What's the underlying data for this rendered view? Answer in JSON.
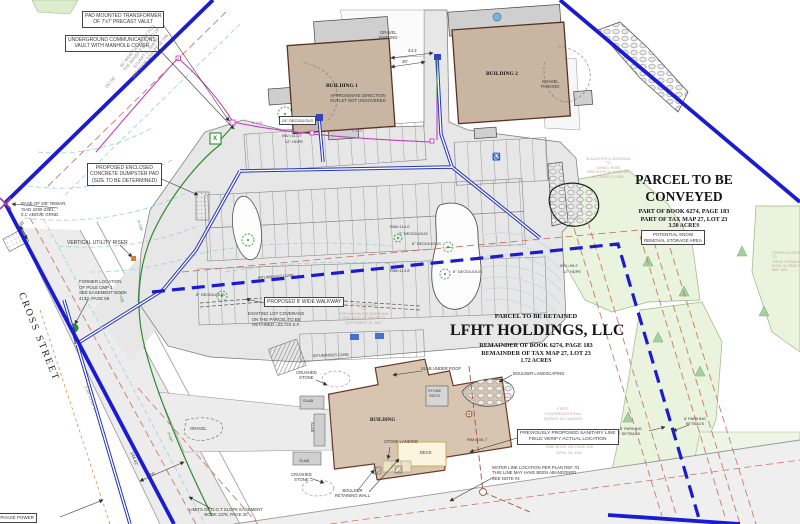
{
  "colors": {
    "boundary_blue": "#1b1bd0",
    "water_blue": "#2233bb",
    "electric_magenta": "#c43ec4",
    "power_green": "#2e8b2e",
    "contour_cyan": "#9fd0d6",
    "setback_red": "#c8796b",
    "building_fill": "#c8b6a3",
    "building_outline": "#5d3222",
    "pavement_gray": "#e7e7e7",
    "vegetation_green": "#e9f3dd"
  },
  "parcel_conveyed": {
    "t1": "PARCEL TO BE",
    "t2": "CONVEYED",
    "l1": "PART OF BOOK 6274, PAGE 183",
    "l2": "PART OF TAX MAP 27, LOT 23",
    "l3": "3.50 ACRES"
  },
  "parcel_retained": {
    "sub": "PARCEL TO BE RETAINED",
    "t": "LFHT HOLDINGS, LLC",
    "l1": "REMAINDER OF BOOK 6274, PAGE 183",
    "l2": "REMAINDER OF TAX MAP 27, LOT 23",
    "l3": "1.72 ACRES"
  },
  "callouts": {
    "pad": [
      "PAD MOUNTED TRANSFORMER",
      "OF 7'x7' PRECAST VAULT"
    ],
    "comm": [
      "UNDERGROUND COMMUNICATIONS",
      "VAULT WITH MANHOLE COVER"
    ],
    "dumpster": [
      "PROPOSED ENCLOSED",
      "CONCRETE DUMPSTER PAD",
      "(SIZE TO BE DETERMINED)"
    ],
    "walkway": "PROPOSED 8' WIDE WALKWAY",
    "snow": [
      "POTENTIAL SNOW",
      "REMOVAL STORAGE AREA"
    ],
    "sanitary": [
      "PREVIOUSLY PROPOSED SANITARY LINE",
      "FIELD VERIFY ACTUAL LOCATION"
    ],
    "phase_power": "E TO 3 PHASE POWER",
    "dec24": "24\" DECIDUOUS"
  },
  "notes": {
    "easement": [
      "50' WIDE EASEMENT FOR",
      "THE BENEFIT OF LAND OF",
      "STUART G. SMITH",
      "SEE BOOK 5228, PAGE 246"
    ],
    "rebar": [
      "BASE OF 5/8\" REBAR,",
      "'GAD 2290-2391',",
      "0.1' ABOVE GRND."
    ],
    "riser": "VERTICAL UTILITY RISER",
    "pole": [
      "FORMER LOCATION",
      "OF POLE CMP 1",
      "SEE EASEMENT BOOK",
      "4133, PAGE 59"
    ],
    "coverage": [
      "EXISTING LOT COVERAGE",
      "ON THE PARCEL TO BE",
      "RETAINED =23,723 S.F."
    ],
    "dot": [
      "LIMITS OF D.O.T SLOPE EASEMENT",
      "BOOK 1378, PAGE 20"
    ],
    "water": [
      "WATER LINE LOCATION PER PLAN REF. #1",
      "THIS LINE MAY HAVE BEEN ABANDONED",
      "SEE NOTE #4"
    ],
    "setback": [
      "8' PARKING",
      "SETBACK"
    ]
  },
  "deeds": {
    "upham": [
      "JETER UPHAM",
      "TO",
      "JOB WASHBURN INGRAHAM",
      "WBK BOOK 47, PAGE 583",
      "SEPTEMBER 30, 1847"
    ],
    "slaughter": [
      "SLAUGHTER & INGRAHAM",
      "TO",
      "JOHN D. ROSE",
      "WBK BOOK 54, PAGE 361",
      "OCTOBER 10, 1851"
    ],
    "joseph": [
      "JOSEPHUS ROSE",
      "TO",
      "JOB W. INGRAHAM",
      "BOOK 34, PAGE 9",
      "MAY 1841"
    ],
    "congregational": [
      "FIRST",
      "CONGREGATIONAL",
      "PARISH IN CAMDEN",
      "WBK BOOK 492 PAGE 298",
      "APRIL 28, 1941"
    ]
  },
  "site": {
    "cross_street": "CROSS STREET",
    "building1": "BUILDING 1",
    "building2": "BUILDING 2",
    "building": "BUILDING",
    "approx": [
      "APPROXIMATE DIRECTION",
      "OUTLET NOT UNCOVERED"
    ],
    "gravel": "GRAVEL",
    "parking": "PARKING",
    "bituminous_curb": "BITUMINOUS CURB",
    "crushed": [
      "CRUSHED",
      "STONE"
    ],
    "slab": "SLAB",
    "slab_under_roof": "SLAB UNDER ROOF",
    "stone_patio": [
      "STONE",
      "PATIO"
    ],
    "stone_landing": "STONE LANDING",
    "deck": "DECK",
    "boulder_wall": [
      "BOULDER",
      "RETAINING WALL"
    ],
    "boulder_landscaping": "BOULDER LANDSCAPING"
  },
  "dims": {
    "d441": "44.1'",
    "d30": "30'",
    "d25780": "257.80'",
    "d14442": "144.42'",
    "d55": "55'",
    "d35": "35'",
    "bearing": "S 49°13'26\" W"
  },
  "utilities": {
    "inv1137": "INV.=113.7'",
    "hdpe12": "12\" HDPE",
    "rim1140": "RIM=114.0'",
    "rim1135": "RIM=113.5'",
    "rim1067": "RIM=106.7'",
    "inv992": "INV.=99.2'",
    "eug": "E-U/G",
    "pug": "P-U/G",
    "poh": "P-OH",
    "x": "X",
    "dec8": "8\" DECIDUOUS",
    "dec6": "6\" DECIDUOUS",
    "dec2": "2\" DECIDUOUS",
    "handicap": "♿"
  }
}
